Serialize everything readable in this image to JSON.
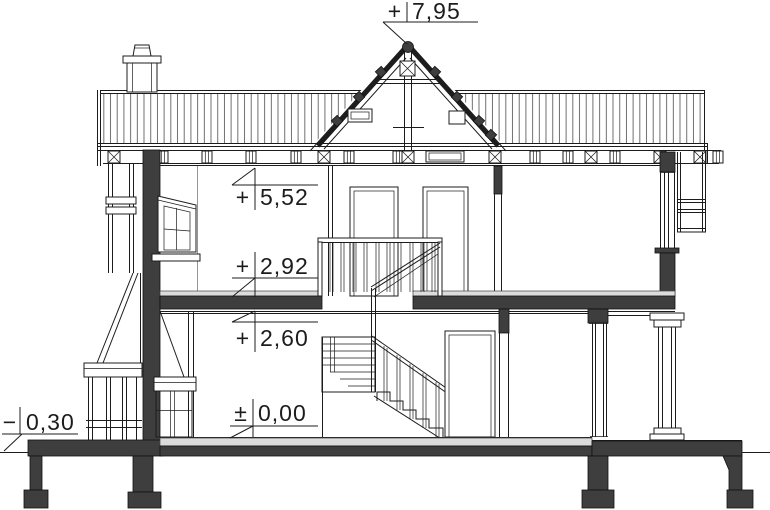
{
  "drawing": {
    "colors": {
      "line": "#1c1c1c",
      "cut": "#3e3e3e",
      "screed": "#dcdcdc",
      "hatch": "#5f5f5f",
      "background": "#ffffff"
    },
    "elevation_markers": [
      {
        "id": "ridge",
        "sign": "+",
        "value": "7,95"
      },
      {
        "id": "eaves",
        "sign": "+",
        "value": "5,52"
      },
      {
        "id": "attic-floor",
        "sign": "+",
        "value": "2,92"
      },
      {
        "id": "ground-ceiling",
        "sign": "+",
        "value": "2,60"
      },
      {
        "id": "ground-floor",
        "sign": "±",
        "value": "0,00"
      },
      {
        "id": "terrain",
        "sign": "−",
        "value": "0,30"
      }
    ]
  }
}
